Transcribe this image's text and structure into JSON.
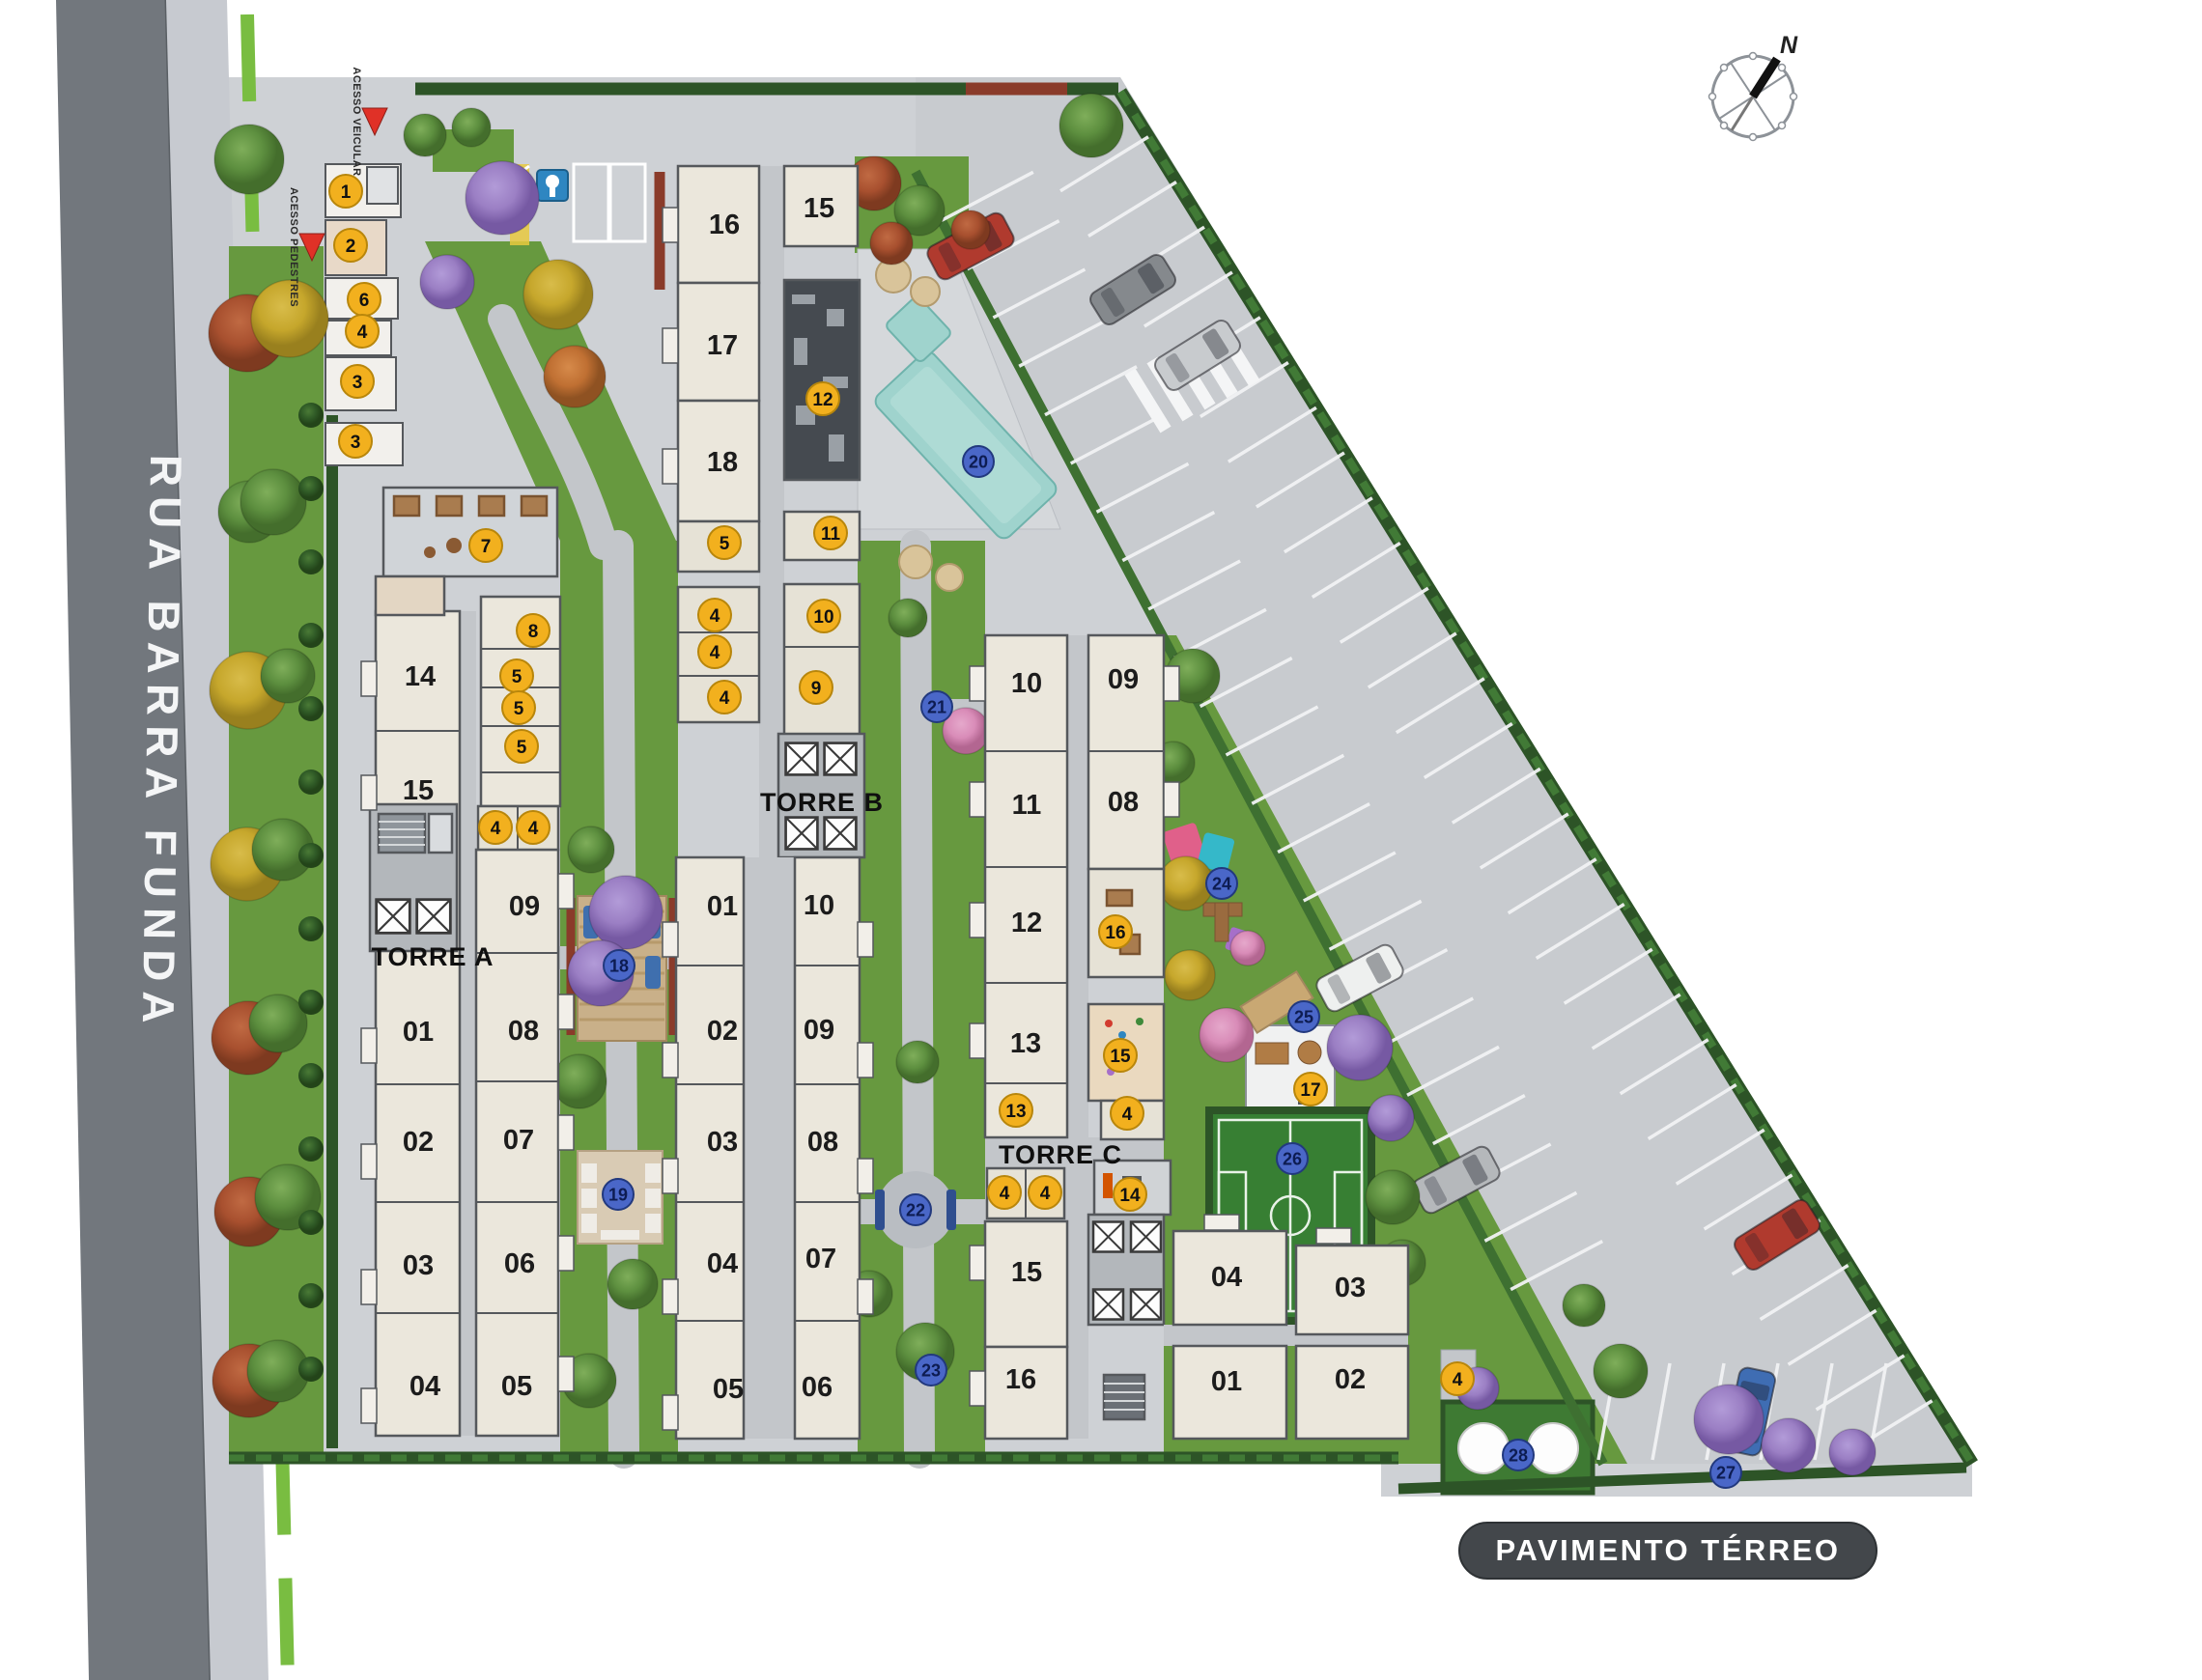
{
  "plan_label": "PAVIMENTO TÉRREO",
  "street": {
    "name": "RUA BARRA FUNDA"
  },
  "compass": {
    "north": "N"
  },
  "access": {
    "vehicular": "ACESSO VEICULAR",
    "pedestrian": "ACESSO PEDESTRES"
  },
  "towers": [
    {
      "name": "TORRE A",
      "units": [
        "14",
        "15",
        "09",
        "01",
        "08",
        "02",
        "07",
        "03",
        "06",
        "04",
        "05"
      ]
    },
    {
      "name": "TORRE B",
      "units": [
        "16",
        "15",
        "17",
        "18",
        "01",
        "10",
        "02",
        "09",
        "03",
        "08",
        "04",
        "07",
        "05",
        "06"
      ]
    },
    {
      "name": "TORRE C",
      "units": [
        "10",
        "09",
        "11",
        "08",
        "12",
        "13",
        "15",
        "16",
        "04",
        "03",
        "01",
        "02"
      ]
    }
  ],
  "markers": {
    "yellow": [
      {
        "n": "1"
      },
      {
        "n": "2"
      },
      {
        "n": "6"
      },
      {
        "n": "4"
      },
      {
        "n": "3"
      },
      {
        "n": "3"
      },
      {
        "n": "7"
      },
      {
        "n": "8"
      },
      {
        "n": "5"
      },
      {
        "n": "5"
      },
      {
        "n": "5"
      },
      {
        "n": "4"
      },
      {
        "n": "4"
      },
      {
        "n": "5"
      },
      {
        "n": "11"
      },
      {
        "n": "4"
      },
      {
        "n": "4"
      },
      {
        "n": "4"
      },
      {
        "n": "10"
      },
      {
        "n": "9"
      },
      {
        "n": "12"
      },
      {
        "n": "16"
      },
      {
        "n": "15"
      },
      {
        "n": "13"
      },
      {
        "n": "4"
      },
      {
        "n": "4"
      },
      {
        "n": "4"
      },
      {
        "n": "14"
      },
      {
        "n": "17"
      },
      {
        "n": "4"
      }
    ],
    "blue": [
      {
        "n": "18"
      },
      {
        "n": "19"
      },
      {
        "n": "20"
      },
      {
        "n": "21"
      },
      {
        "n": "22"
      },
      {
        "n": "23"
      },
      {
        "n": "24"
      },
      {
        "n": "25"
      },
      {
        "n": "26"
      },
      {
        "n": "27"
      },
      {
        "n": "28"
      }
    ]
  },
  "colors": {
    "marker_yellow": "#f2b01e",
    "marker_blue": "#4a67c8",
    "street": "#72777d",
    "lawn": "#67993f",
    "building": "#ebe7dc",
    "pool": "#a5d6d0",
    "field": "#3f8a3a",
    "title_bar": "#43474b"
  }
}
